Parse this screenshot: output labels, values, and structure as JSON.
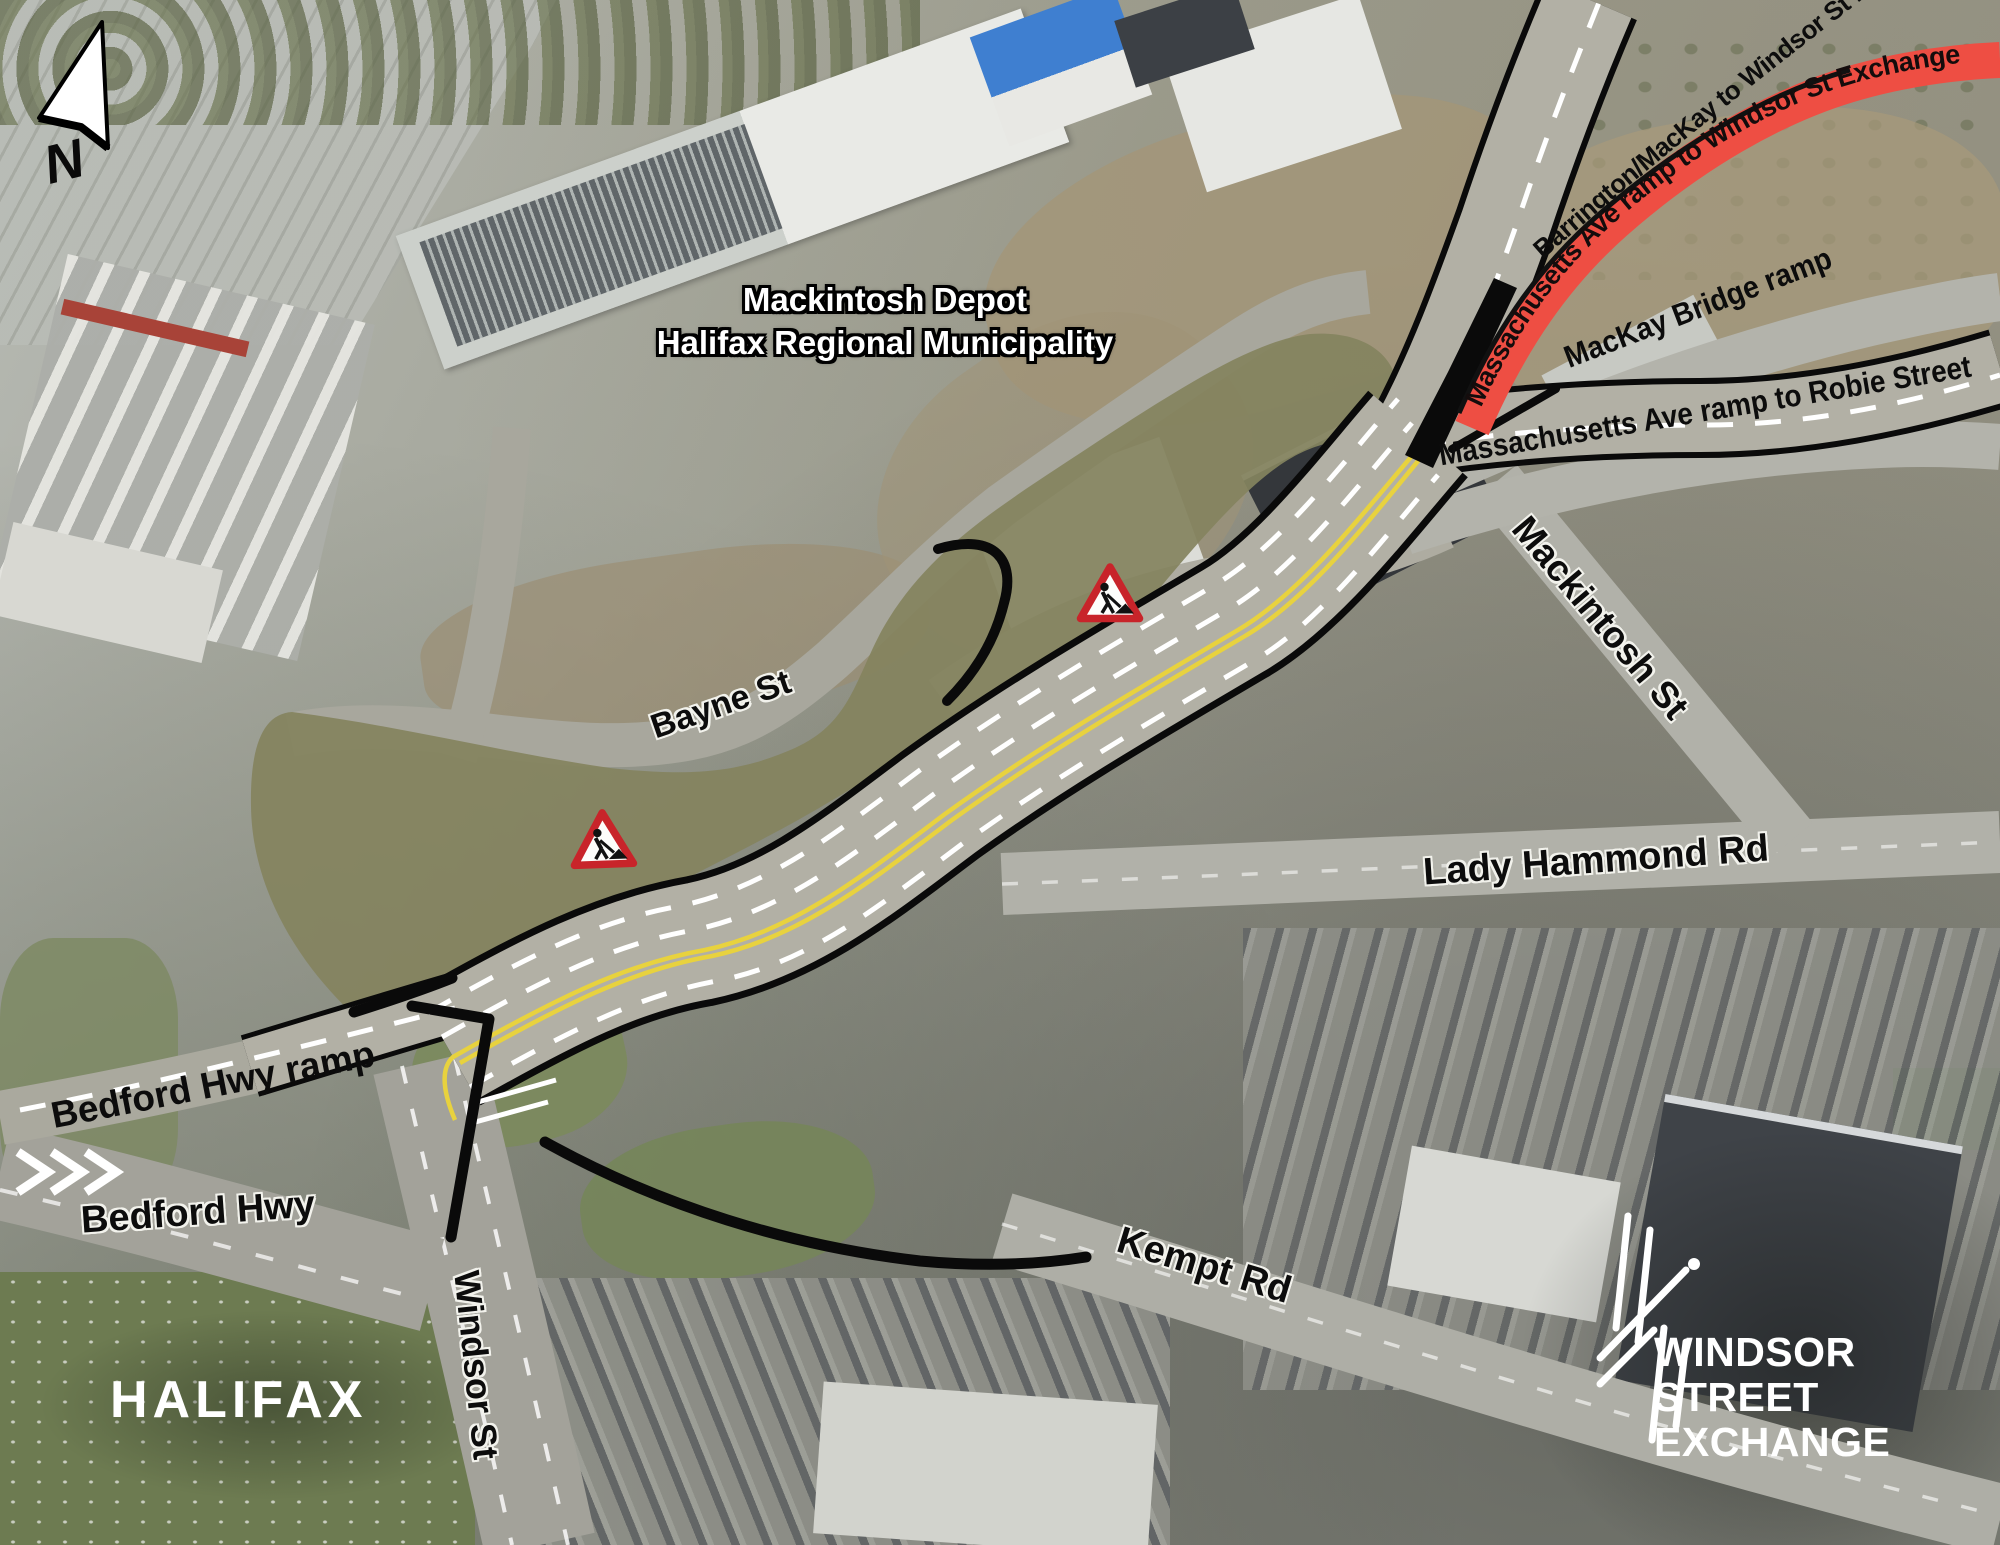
{
  "page": {
    "type": "aerial-construction-map",
    "project": "Windsor Street Exchange"
  },
  "compass": {
    "north_label": "N"
  },
  "overlay_labels": {
    "depot_line1": "Mackintosh Depot",
    "depot_line2": "Halifax Regional Municipality"
  },
  "street_labels": {
    "bayne_st": "Bayne St",
    "bedford_hwy_ramp": "Bedford Hwy ramp",
    "bedford_hwy": "Bedford Hwy",
    "windsor_st": "Windsor St",
    "kempt_rd": "Kempt Rd",
    "lady_hammond_rd": "Lady Hammond Rd",
    "mackintosh_st": "Mackintosh St",
    "mackay_bridge_ramp": "MacKay Bridge ramp",
    "mass_ave_robie": "Massachusetts Ave ramp to Robie Street",
    "barrington_mackay": "Barrington/MacKay to Windsor St Exchange",
    "mass_ave_windsor": "Massachusetts Ave ramp to Windsor St Exchange"
  },
  "logos": {
    "halifax_wordmark": "HALIFAX",
    "project_line1": "WINDSOR",
    "project_line2": "STREET",
    "project_line3": "EXCHANGE"
  },
  "icons": {
    "construction_sign": "roadworks-warning-triangle",
    "north_arrow": "north-arrow",
    "interchange_logo": "interchange-lines"
  },
  "colors": {
    "corridor_olive": "#84835f",
    "closure_red": "#ee4e43",
    "annotation_black": "#0a0a0a",
    "lane_yellow": "#e8d23e",
    "road_gray": "#b2b0a5"
  }
}
